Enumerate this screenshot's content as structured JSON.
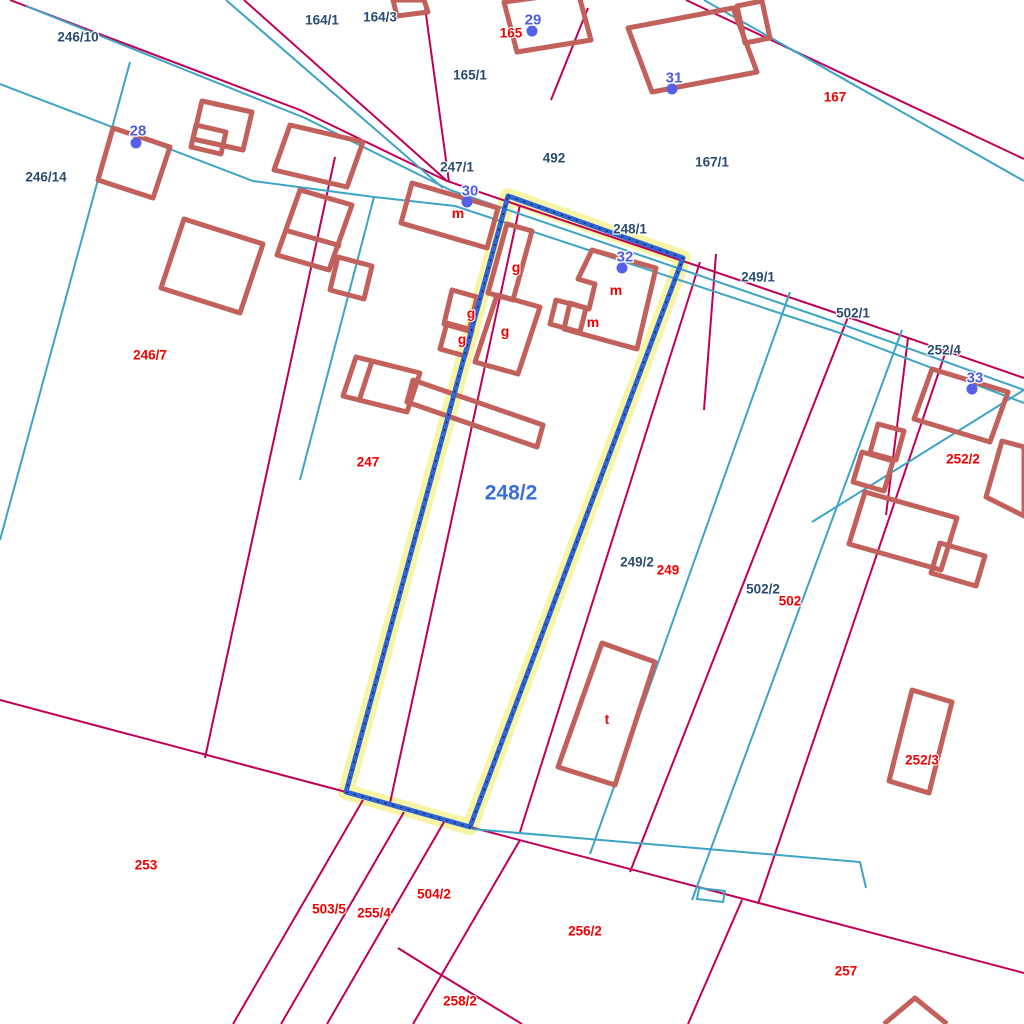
{
  "map": {
    "type": "cadastral-parcel-map",
    "selected_parcel": {
      "id": "248/2"
    },
    "labels": [
      {
        "cls": "dark",
        "text": "246/10",
        "x": 78,
        "y": 37
      },
      {
        "cls": "dark",
        "text": "164/1",
        "x": 322,
        "y": 20
      },
      {
        "cls": "dark",
        "text": "164/3",
        "x": 380,
        "y": 17
      },
      {
        "cls": "dark",
        "text": "165/1",
        "x": 470,
        "y": 75
      },
      {
        "cls": "dark",
        "text": "492",
        "x": 554,
        "y": 158
      },
      {
        "cls": "dark",
        "text": "167/1",
        "x": 712,
        "y": 162
      },
      {
        "cls": "dark",
        "text": "246/14",
        "x": 46,
        "y": 177
      },
      {
        "cls": "dark",
        "text": "247/1",
        "x": 457,
        "y": 167
      },
      {
        "cls": "dark",
        "text": "248/1",
        "x": 630,
        "y": 229
      },
      {
        "cls": "dark",
        "text": "249/1",
        "x": 758,
        "y": 277
      },
      {
        "cls": "dark",
        "text": "502/1",
        "x": 853,
        "y": 313
      },
      {
        "cls": "dark",
        "text": "252/4",
        "x": 944,
        "y": 350
      },
      {
        "cls": "dark",
        "text": "249/2",
        "x": 637,
        "y": 562
      },
      {
        "cls": "dark",
        "text": "502/2",
        "x": 763,
        "y": 589
      },
      {
        "cls": "red",
        "text": "165",
        "x": 511,
        "y": 33
      },
      {
        "cls": "red",
        "text": "167",
        "x": 835,
        "y": 97
      },
      {
        "cls": "red",
        "text": "246/7",
        "x": 150,
        "y": 355
      },
      {
        "cls": "red",
        "text": "247",
        "x": 368,
        "y": 462
      },
      {
        "cls": "red",
        "text": "249",
        "x": 668,
        "y": 570
      },
      {
        "cls": "red",
        "text": "502",
        "x": 790,
        "y": 601
      },
      {
        "cls": "red",
        "text": "252/2",
        "x": 963,
        "y": 459
      },
      {
        "cls": "red",
        "text": "252/3",
        "x": 922,
        "y": 760
      },
      {
        "cls": "red",
        "text": "253",
        "x": 146,
        "y": 865
      },
      {
        "cls": "red",
        "text": "503/5",
        "x": 329,
        "y": 909
      },
      {
        "cls": "red",
        "text": "255/4",
        "x": 374,
        "y": 913
      },
      {
        "cls": "red",
        "text": "504/2",
        "x": 434,
        "y": 894
      },
      {
        "cls": "red",
        "text": "256/2",
        "x": 585,
        "y": 931
      },
      {
        "cls": "red",
        "text": "258/2",
        "x": 460,
        "y": 1001
      },
      {
        "cls": "red",
        "text": "257",
        "x": 846,
        "y": 971
      },
      {
        "cls": "use",
        "text": "m",
        "x": 458,
        "y": 213
      },
      {
        "cls": "use",
        "text": "g",
        "x": 516,
        "y": 267
      },
      {
        "cls": "use",
        "text": "g",
        "x": 471,
        "y": 313
      },
      {
        "cls": "use",
        "text": "g",
        "x": 462,
        "y": 339
      },
      {
        "cls": "use",
        "text": "g",
        "x": 505,
        "y": 331
      },
      {
        "cls": "use",
        "text": "m",
        "x": 616,
        "y": 290
      },
      {
        "cls": "use",
        "text": "m",
        "x": 593,
        "y": 322
      },
      {
        "cls": "use",
        "text": "t",
        "x": 607,
        "y": 719
      },
      {
        "cls": "sel",
        "text": "248/2",
        "x": 511,
        "y": 493
      }
    ],
    "points": [
      {
        "n": "28",
        "tx": 138,
        "ty": 131,
        "dx": 136,
        "dy": 143
      },
      {
        "n": "29",
        "tx": 533,
        "ty": 20,
        "dx": 532,
        "dy": 31
      },
      {
        "n": "30",
        "tx": 470,
        "ty": 191,
        "dx": 467,
        "dy": 202
      },
      {
        "n": "31",
        "tx": 674,
        "ty": 78,
        "dx": 672,
        "dy": 89
      },
      {
        "n": "32",
        "tx": 625,
        "ty": 257,
        "dx": 622,
        "dy": 268
      },
      {
        "n": "33",
        "tx": 975,
        "ty": 378,
        "dx": 972,
        "dy": 389
      }
    ]
  },
  "colors": {
    "parcel_line": "#c00057",
    "utility_line": "#3da4c6",
    "building": "#c2615c",
    "label_dark": "#2b4c70",
    "label_red": "#f20000",
    "label_point": "#4d5ce8",
    "label_selected": "#3a6fd8",
    "point_dot": "#5560e8",
    "selection_stroke": "#2e66d9",
    "selection_halo": "#f8f3a1",
    "selection_dash": "#222222",
    "background": "#ffffff"
  }
}
